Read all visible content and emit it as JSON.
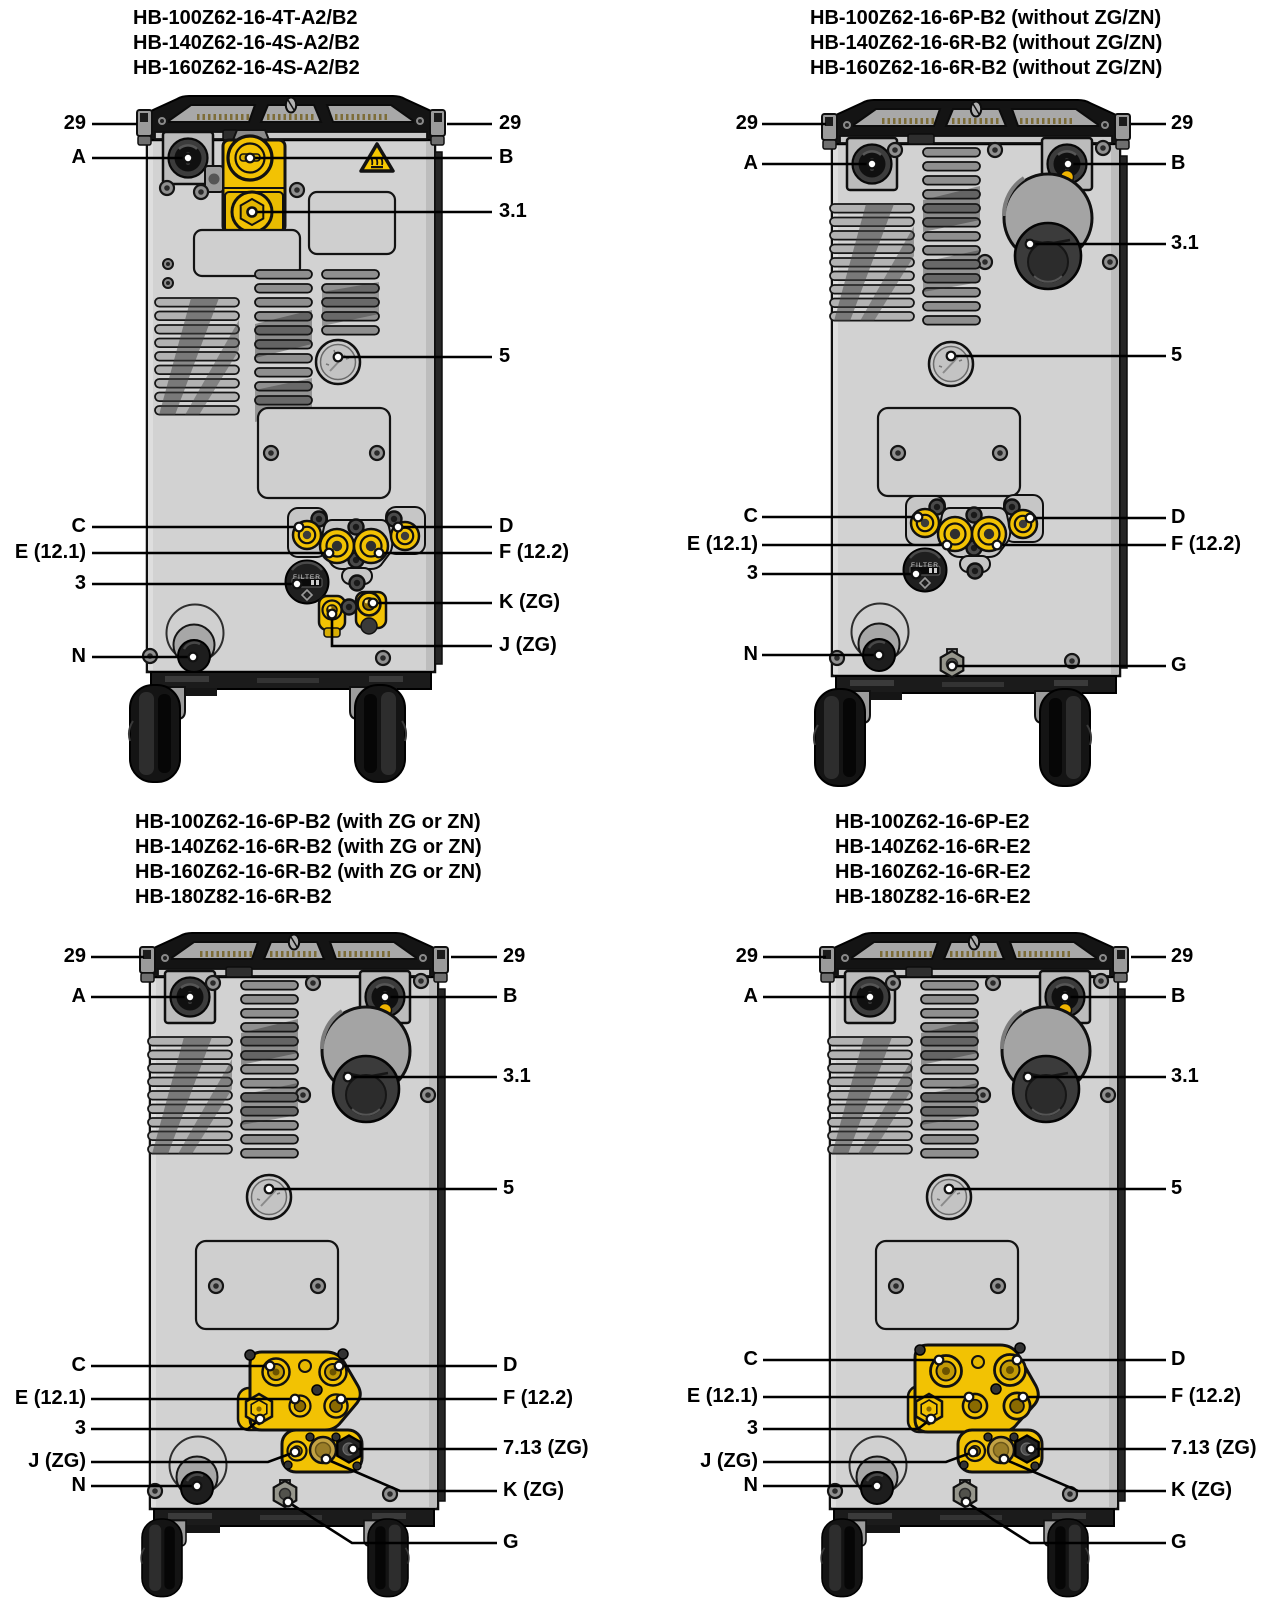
{
  "figure": {
    "filter_knob_label": "FILTER",
    "colors": {
      "accent_yellow": "#F2C203",
      "warning_yellow": "#F6C800",
      "brass": "#C3A243",
      "body_gray": "#D2D2D2",
      "dark_housing": "#141414",
      "leader_line": "#000000",
      "background": "#FFFFFF"
    },
    "panels": [
      {
        "id": "top-left",
        "title_lines": [
          "HB-100Z62-16-4T-A2/B2",
          "HB-140Z62-16-4S-A2/B2",
          "HB-160Z62-16-4S-A2/B2"
        ],
        "callouts": [
          "29",
          "A",
          "C",
          "E (12.1)",
          "3",
          "N",
          "29",
          "B",
          "3.1",
          "5",
          "D",
          "F (12.2)",
          "K (ZG)",
          "J (ZG)"
        ]
      },
      {
        "id": "top-right",
        "title_lines": [
          "HB-100Z62-16-6P-B2 (without ZG/ZN)",
          "HB-140Z62-16-6R-B2 (without ZG/ZN)",
          "HB-160Z62-16-6R-B2 (without ZG/ZN)"
        ],
        "callouts": [
          "29",
          "A",
          "C",
          "E (12.1)",
          "3",
          "N",
          "29",
          "B",
          "3.1",
          "5",
          "D",
          "F (12.2)",
          "G"
        ]
      },
      {
        "id": "bottom-left",
        "title_lines": [
          "HB-100Z62-16-6P-B2 (with ZG or ZN)",
          "HB-140Z62-16-6R-B2 (with ZG or ZN)",
          "HB-160Z62-16-6R-B2 (with ZG or ZN)",
          "HB-180Z82-16-6R-B2"
        ],
        "callouts": [
          "29",
          "A",
          "C",
          "E (12.1)",
          "3",
          "J (ZG)",
          "N",
          "29",
          "B",
          "3.1",
          "5",
          "D",
          "F (12.2)",
          "7.13 (ZG)",
          "K (ZG)",
          "G"
        ]
      },
      {
        "id": "bottom-right",
        "title_lines": [
          "HB-100Z62-16-6P-E2",
          "HB-140Z62-16-6R-E2",
          "HB-160Z62-16-6R-E2",
          "HB-180Z82-16-6R-E2"
        ],
        "callouts": [
          "29",
          "A",
          "C",
          "E (12.1)",
          "3",
          "J (ZG)",
          "N",
          "29",
          "B",
          "3.1",
          "5",
          "D",
          "F (12.2)",
          "7.13 (ZG)",
          "K (ZG)",
          "G"
        ]
      }
    ]
  }
}
